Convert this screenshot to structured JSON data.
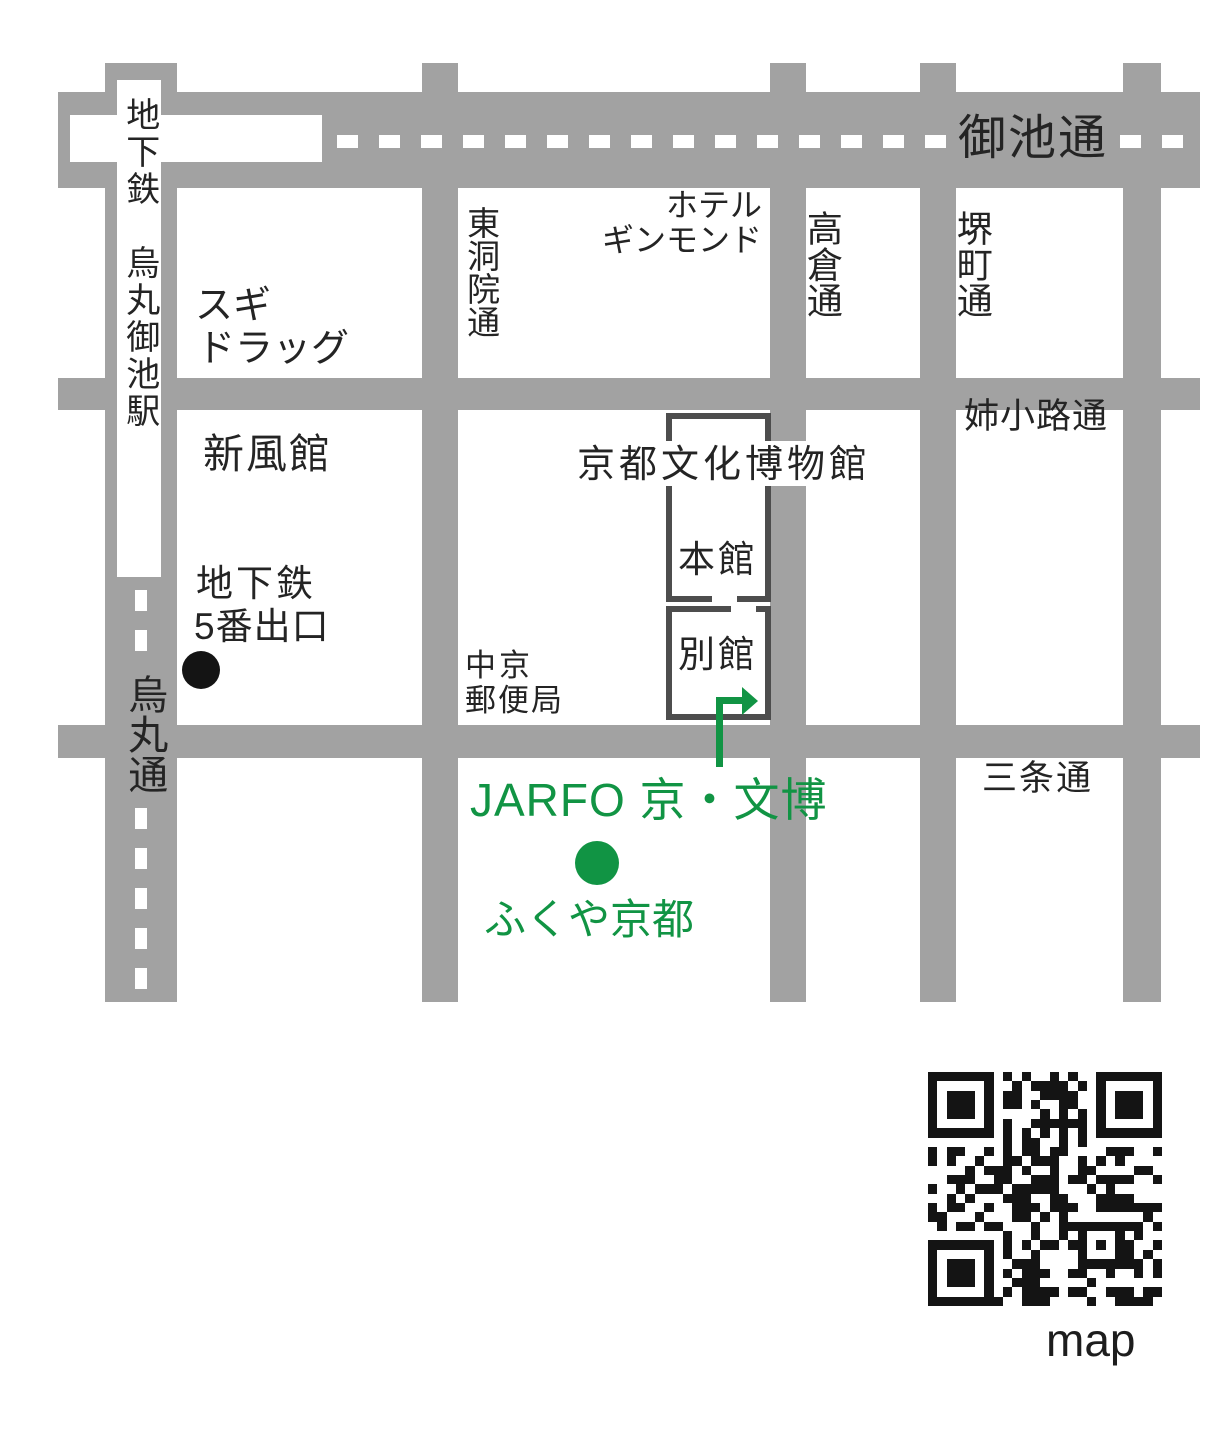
{
  "map": {
    "colors": {
      "road": "#a2a2a2",
      "ink": "#242424",
      "green": "#119444",
      "outline": "#4d4d4d"
    },
    "streets": {
      "oike": "御池通",
      "aneyakoji": "姉小路通",
      "sanjo": "三条通",
      "karasuma": "烏丸通",
      "higashinotoin": "東洞院通",
      "takakura": "高倉通",
      "sakaimachi": "堺町通"
    },
    "places": {
      "station_vertical": "地下鉄　烏丸御池駅",
      "sugi_line1": "スギ",
      "sugi_line2": "ドラッグ",
      "shinpukan": "新風館",
      "hotel_line1": "ホテル",
      "hotel_line2": "ギンモンド",
      "exit_line1": "地下鉄",
      "exit_line2": "5番出口",
      "post_line1": "中京",
      "post_line2": "郵便局",
      "museum": "京都文化博物館",
      "honkan": "本館",
      "bekkan": "別館"
    },
    "venue": {
      "name": "JARFO 京・文博",
      "shop": "ふくや京都"
    },
    "qr_label": "map"
  }
}
